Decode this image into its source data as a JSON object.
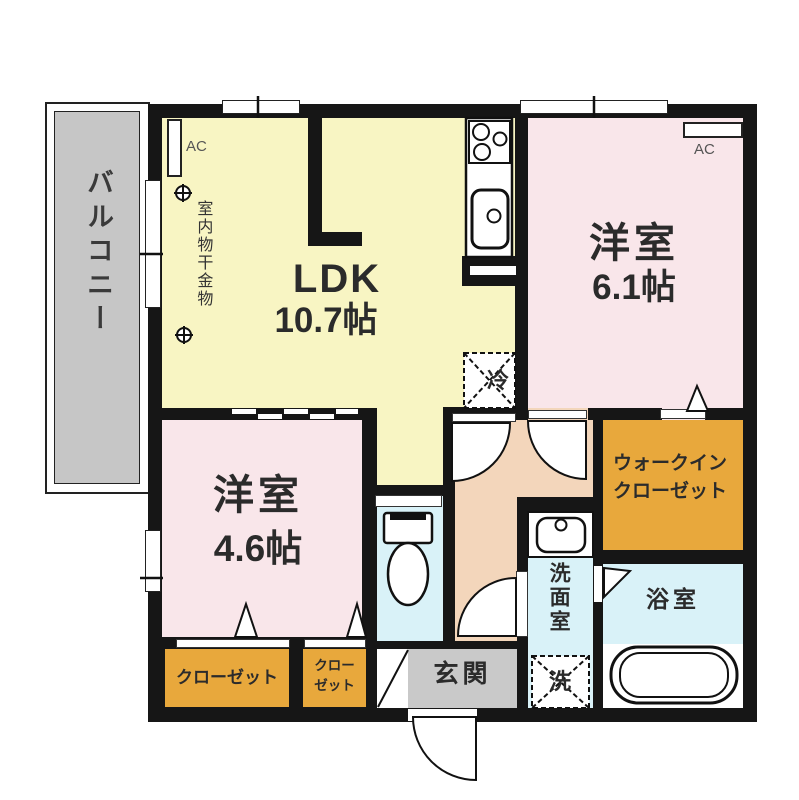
{
  "plan": {
    "balcony": "バルコニー",
    "ldk_name": "LDK",
    "ldk_size": "10.7帖",
    "bedroom1_name": "洋室",
    "bedroom1_size": "6.1帖",
    "bedroom2_name": "洋室",
    "bedroom2_size": "4.6帖",
    "wic_line1": "ウォークイン",
    "wic_line2": "クローゼット",
    "washroom": "洗面室",
    "bathroom": "浴室",
    "entrance": "玄関",
    "closet_wide": "クローゼット",
    "closet_narrow_line1": "クロー",
    "closet_narrow_line2": "ゼット",
    "ac": "AC",
    "indoor_drying": "室内物干金物",
    "refrigerator": "冷",
    "washing_machine": "洗"
  },
  "colors": {
    "wall": "#161616",
    "ldk_floor": "#F8F5C3",
    "bedroom_floor": "#F9E6EA",
    "closet_floor": "#E8A83C",
    "water_area_floor": "#D9F2F8",
    "hallway_floor": "#F3D6BB",
    "balcony_floor": "#C6C6C6",
    "entrance_floor": "#C9C9C9"
  }
}
